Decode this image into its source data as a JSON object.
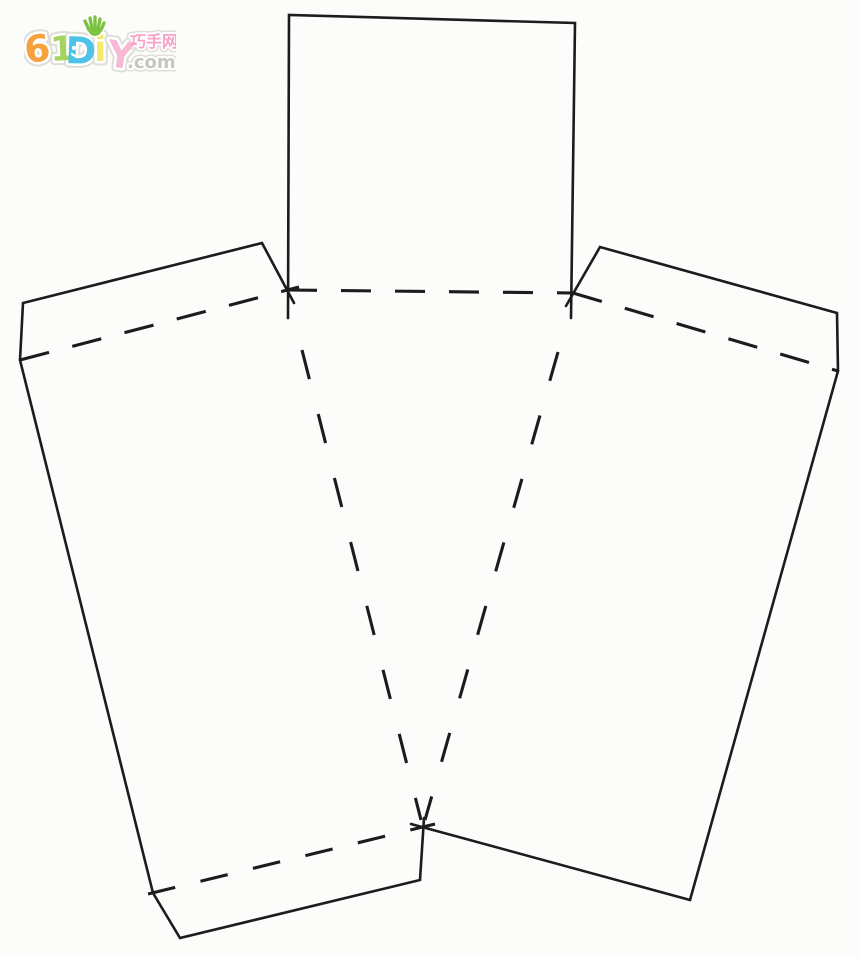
{
  "page": {
    "background_color": "#fcfcfa",
    "description": "Hand-drawn papercraft box/basket template: solid cut lines and dashed fold lines, flaps on top, sides and bottom"
  },
  "logo": {
    "text": "61DIY",
    "letters": [
      {
        "char": "6",
        "color": "#f6a13c",
        "x": 2,
        "y": 49,
        "size": 37,
        "rotate": -7
      },
      {
        "char": "1",
        "color": "#a2d45e",
        "x": 27,
        "y": 47,
        "size": 34,
        "rotate": -3
      },
      {
        "char": "D",
        "color": "#4ec3ea",
        "x": 41,
        "y": 49,
        "size": 37,
        "rotate": 2,
        "face": true
      },
      {
        "char": "i",
        "color": "#f6e96e",
        "x": 70,
        "y": 47,
        "size": 36,
        "rotate": 0,
        "hand": true
      },
      {
        "char": "Y",
        "color": "#f7b9d4",
        "x": 82,
        "y": 52,
        "size": 37,
        "rotate": 7
      }
    ],
    "cn_text": "巧手网",
    "cn_color": "#f6a3c7",
    "domain_text": ".com",
    "domain_color": "#c6c6c2",
    "hand_icon_color": "#7dc243",
    "face_color": "#ffffff",
    "outline_inner": "#ffffff",
    "outline_outer": "#deded8"
  },
  "diagram": {
    "stroke_color": "#1c1c1c",
    "canvas": {
      "width": 859,
      "height": 957
    },
    "cut_lines": [
      {
        "name": "top-flap-square-outline",
        "points": [
          [
            288,
            318
          ],
          [
            289,
            15
          ],
          [
            575,
            23
          ],
          [
            571,
            318
          ]
        ]
      },
      {
        "name": "left-lid-flap-outline",
        "points": [
          [
            294,
            303
          ],
          [
            262,
            243
          ],
          [
            23,
            303
          ],
          [
            20,
            360
          ]
        ]
      },
      {
        "name": "left-panel-side-edge",
        "points": [
          [
            20,
            360
          ],
          [
            153,
            893
          ]
        ]
      },
      {
        "name": "bottom-flap-outline",
        "points": [
          [
            153,
            893
          ],
          [
            180,
            938
          ],
          [
            420,
            880
          ],
          [
            424,
            818
          ]
        ]
      },
      {
        "name": "right-lid-flap-outline",
        "points": [
          [
            566,
            306
          ],
          [
            600,
            247
          ],
          [
            837,
            313
          ],
          [
            838,
            371
          ]
        ]
      },
      {
        "name": "right-panel-side-edge",
        "points": [
          [
            838,
            371
          ],
          [
            690,
            900
          ]
        ]
      },
      {
        "name": "right-panel-bottom-edge",
        "points": [
          [
            690,
            900
          ],
          [
            411,
            824
          ]
        ]
      }
    ],
    "fold_lines": [
      {
        "name": "top-flap-fold",
        "points": [
          [
            287,
            290
          ],
          [
            573,
            293
          ]
        ],
        "dash": [
          30,
          24
        ]
      },
      {
        "name": "left-lid-fold",
        "points": [
          [
            20,
            360
          ],
          [
            299,
            287
          ]
        ],
        "dash": [
          30,
          24
        ]
      },
      {
        "name": "right-lid-fold",
        "points": [
          [
            573,
            293
          ],
          [
            838,
            371
          ]
        ],
        "dash": [
          30,
          24
        ]
      },
      {
        "name": "bottom-flap-fold",
        "points": [
          [
            148,
            894
          ],
          [
            435,
            824
          ]
        ],
        "dash": [
          28,
          26
        ]
      },
      {
        "name": "center-left-fold",
        "points": [
          [
            302,
            350
          ],
          [
            421,
            820
          ]
        ],
        "dash": [
          30,
          36
        ]
      },
      {
        "name": "center-right-fold",
        "points": [
          [
            558,
            352
          ],
          [
            425,
            820
          ]
        ],
        "dash": [
          30,
          36
        ]
      }
    ]
  }
}
